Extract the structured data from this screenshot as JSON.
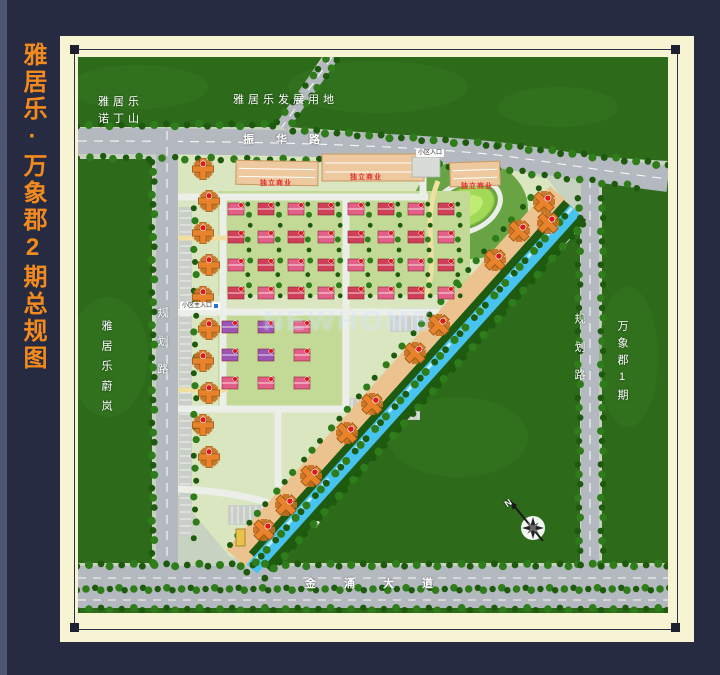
{
  "title": "雅居乐·万象郡2期总规图",
  "map_labels": {
    "adjacent_nw_line1": "雅居乐",
    "adjacent_nw_line2": "诺丁山",
    "development_land": "雅居乐发展用地",
    "road_top": "振华路",
    "road_left": "规划路",
    "road_right": "规划路",
    "adjacent_west": "雅居乐蔚岚",
    "adjacent_east": "万象郡1期",
    "road_bottom": "金涌大道",
    "commercial_1": "独立商业",
    "commercial_2": "独立商业",
    "commercial_3": "独立商业",
    "entrance_main": "小区主入口",
    "entrance_north": "小区入口",
    "compass_n": "N",
    "watermark": "NEWHOME"
  },
  "colors": {
    "bg_navy": "#262b42",
    "title_orange": "#f28a1d",
    "frame_cream": "#f7f4d4",
    "green_dark": "#2d6b1b",
    "green_mid": "#3a7d24",
    "tree_dark": "#1d5a0e",
    "tree_light": "#2f7d1a",
    "site_bg": "#d9e6c0",
    "villa_bg": "#c3da96",
    "road_gray": "#b3b9bf",
    "road_white": "#eceee8",
    "canal_blue": "#46c4ef",
    "canal_sheen": "#b9ecfa",
    "bank_green": "#1e5a10",
    "tan_strip": "#ecc28e",
    "building_orange": "#e8832c",
    "building_stroke": "#9c5a12",
    "roof_pink": "#e26087",
    "roof_red": "#cf4058",
    "roof_purple": "#9a55b5",
    "roof_stroke": "#8a2438",
    "badge_red": "#e01818",
    "lawn_green": "#a2d957",
    "path_yellow": "#efe0a2",
    "parking_gray": "#c9cec9"
  }
}
